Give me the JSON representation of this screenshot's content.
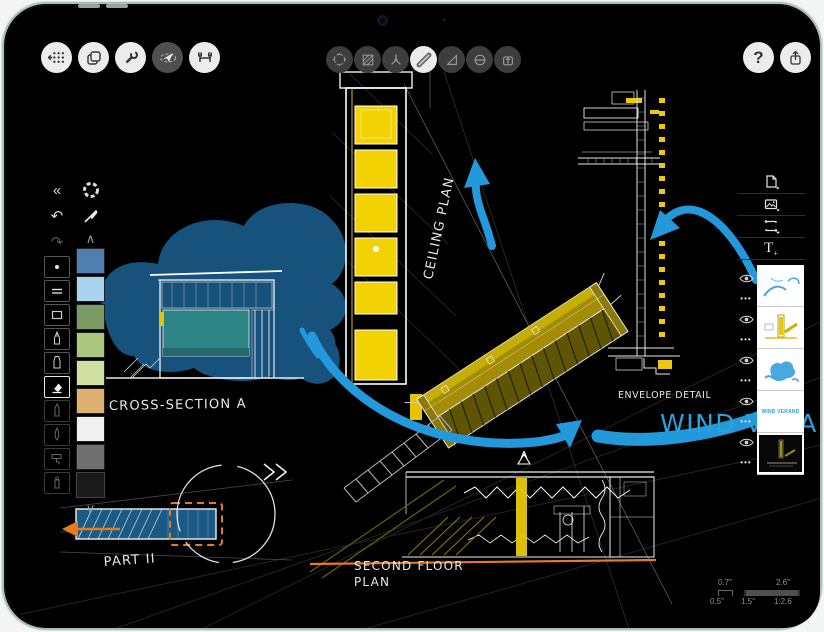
{
  "app": {
    "name": "sketching-app-on-tablet"
  },
  "colors": {
    "canvas_bg": "#000000",
    "accent_blue": "#2398da",
    "accent_yellow": "#f2d203",
    "accent_olive": "#a38d06",
    "accent_orange": "#e87a20",
    "blob_blue": "#16527c",
    "teal_fill": "#2e8585",
    "device_edge": "#aebdb9"
  },
  "icons": {
    "collapse": "«",
    "undo": "↶",
    "redo": "↷",
    "chevron_up": "∧",
    "chevron_down": "∨",
    "help": "?",
    "ellipsis": "•••"
  },
  "toolbars": {
    "left": [
      {
        "name": "gallery-button"
      },
      {
        "name": "pages-button"
      },
      {
        "name": "settings-button"
      },
      {
        "name": "selection-button",
        "selected": true
      },
      {
        "name": "precision-button"
      }
    ],
    "center": [
      {
        "name": "move-tool"
      },
      {
        "name": "fill-tool"
      },
      {
        "name": "compass-tool"
      },
      {
        "name": "pen-tool",
        "selected": true
      },
      {
        "name": "ruler-tool"
      },
      {
        "name": "slice-tool"
      },
      {
        "name": "mask-tool"
      }
    ],
    "right": [
      {
        "name": "help-button",
        "label": "?"
      },
      {
        "name": "share-button"
      }
    ]
  },
  "sidebar": {
    "collapse_label": "«",
    "tools": [
      "dot-brush",
      "double-line",
      "filled-stroke",
      "fineliner",
      "marker",
      "eraser",
      "pencil",
      "brush",
      "roller",
      "airbrush"
    ],
    "selected_tool": "eraser",
    "swatches": [
      "#4d80b0",
      "#a9d3ee",
      "#7c9a63",
      "#a9c87e",
      "#cfe0a0",
      "#deb071",
      "#f0f0ee",
      "#707070",
      "#1a1a1a"
    ]
  },
  "layers": {
    "add_buttons": [
      "new-page",
      "import-image",
      "new-frame",
      "new-text"
    ],
    "ellipsis": "•••",
    "items": [
      {
        "name": "arrows-layer"
      },
      {
        "name": "yellow-plans-layer"
      },
      {
        "name": "blue-wash-layer"
      },
      {
        "name": "title-layer",
        "text": "WIND VERAND"
      },
      {
        "name": "base-drawing-layer",
        "selected": true
      }
    ]
  },
  "labels": {
    "cross_section": "CROSS-SECTION A",
    "ceiling_plan": "CEILING PLAN",
    "second_floor_line1": "SECOND FLOOR",
    "second_floor_line2": "PLAN",
    "envelope_detail": "ENVELOPE DETAIL",
    "part": "PART II",
    "wind_banner": "WIND VERAND",
    "marker_a": "A"
  },
  "scale_bar": {
    "screen_small": "0.7″",
    "screen_large": "2.6″",
    "real_small": "0.5″",
    "real_mid": "1.5″",
    "real_large": "1:2.6"
  }
}
